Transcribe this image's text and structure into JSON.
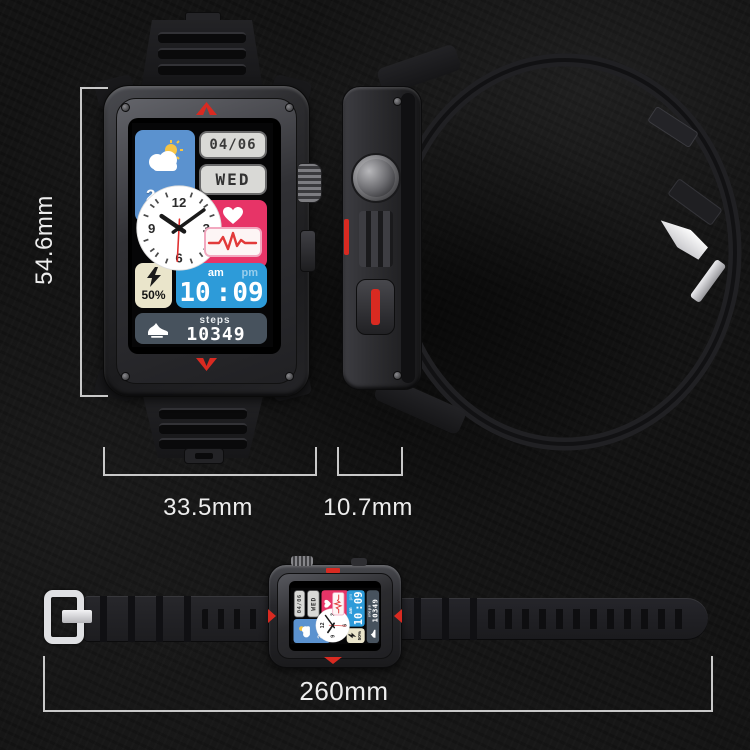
{
  "annotations": {
    "height": "54.6mm",
    "width": "33.5mm",
    "thickness": "10.7mm",
    "band_length": "260mm"
  },
  "watch_face": {
    "weather_temp": "24°C",
    "date": "04/06",
    "weekday": "WED",
    "heart_rate": "104",
    "battery_percent": "50%",
    "am_label": "am",
    "pm_label": "pm",
    "time_hours": "10",
    "time_separator": ":",
    "time_minutes": "09",
    "steps_label": "steps",
    "steps_count": "10349",
    "clock": {
      "n12": "12",
      "n3": "3",
      "n6": "6",
      "n9": "9"
    }
  },
  "icons": {
    "weather": "sun-cloud-icon",
    "heart": "heart-icon",
    "ecg": "ecg-waveform-icon",
    "battery": "lightning-icon",
    "steps": "running-shoe-icon"
  },
  "colors": {
    "accent_red": "#d92a21",
    "weather_blue": "#5b92cf",
    "time_blue": "#2d9bd9",
    "heart_pink": "#e73467",
    "battery_cream": "#eae5cb",
    "steps_slate": "#47525d",
    "tile_gray": "#d9d9d6",
    "annotation_gray": "#ededed",
    "background": "#141414"
  }
}
